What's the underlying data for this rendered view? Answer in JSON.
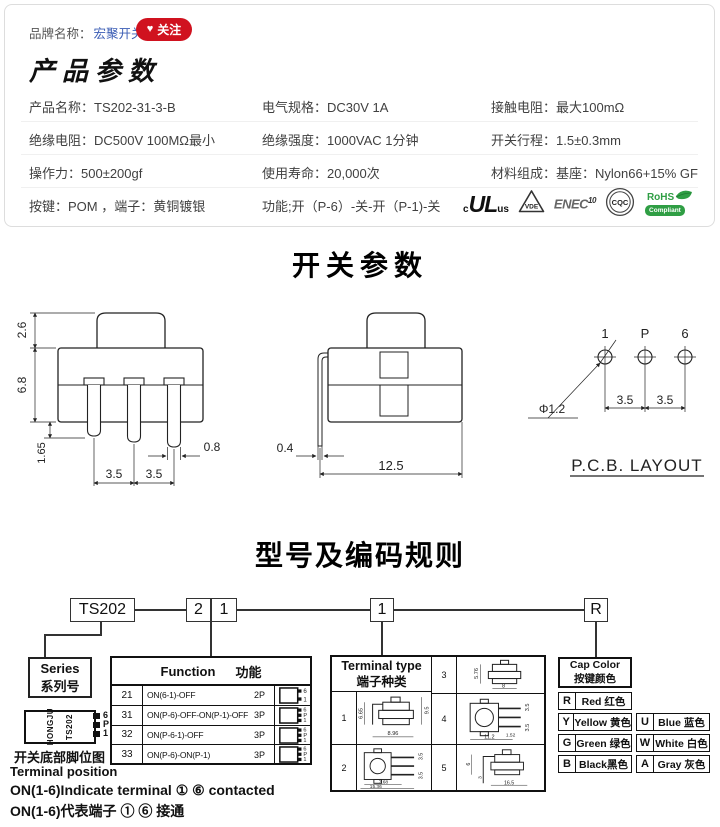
{
  "colors": {
    "brand_link": "#3b5db5",
    "follow_red": "#d0121f",
    "rohs_green": "#2f9e44"
  },
  "header": {
    "brand_label": "品牌名称：",
    "brand_name": "宏聚开关",
    "heart": "♥",
    "follow_label": "关注",
    "section_title": "产品参数"
  },
  "specs": {
    "rows": [
      {
        "c1": "产品名称：TS202-31-3-B",
        "c2": "电气规格：DC30V  1A",
        "c3": "接触电阻：最大100mΩ"
      },
      {
        "c1": "绝缘电阻：DC500V  100MΩ最小",
        "c2": "绝缘强度：1000VAC  1分钟",
        "c3": "开关行程：1.5±0.3mm"
      },
      {
        "c1": "操作力：500±200gf",
        "c2": "使用寿命：20,000次",
        "c3": "材料组成：基座：Nylon66+15% GF"
      },
      {
        "c1": "按键：POM ，端子：黄铜镀银",
        "c2": "功能;开（P-6）-关-开（P-1)-关"
      }
    ],
    "certs": {
      "ul_prefix": "c",
      "ul": "UL",
      "ul_suffix": "us",
      "vde": "VDE",
      "enec": "ENEC",
      "enec_num": "10",
      "cqc": "CQC",
      "rohs": "RoHS",
      "rohs_sub": "Compliant"
    }
  },
  "switch_section": {
    "title": "开关参数",
    "front": {
      "dim_26": "2.6",
      "dim_68": "6.8",
      "dim_165": "1.65",
      "dim_35a": "3.5",
      "dim_35b": "3.5",
      "dim_08": "0.8"
    },
    "side": {
      "dim_04": "0.4",
      "dim_125": "12.5"
    },
    "pcb": {
      "t1": "1",
      "tP": "P",
      "t6": "6",
      "hole": "Φ1.2",
      "p1": "3.5",
      "p2": "3.5",
      "caption": "P.C.B. LAYOUT"
    }
  },
  "coding": {
    "title": "型号及编码规则",
    "box_series": "TS202",
    "box_f1": "2",
    "box_f2": "1",
    "box_t": "1",
    "box_c": "R",
    "series_en": "Series",
    "series_cn": "系列号",
    "function": {
      "en": "Function",
      "cn": "功能",
      "rows": [
        {
          "code": "21",
          "desc": "ON(6-1)-OFF",
          "poles": "2P",
          "pins": [
            "6",
            "1"
          ]
        },
        {
          "code": "31",
          "desc": "ON(P-6)-OFF-ON(P-1)-OFF",
          "poles": "3P",
          "pins": [
            "6",
            "P",
            "1"
          ]
        },
        {
          "code": "32",
          "desc": "ON(P-6-1)-OFF",
          "poles": "3P",
          "pins": [
            "6",
            "P",
            "1"
          ]
        },
        {
          "code": "33",
          "desc": "ON(P-6)-ON(P-1)",
          "poles": "3P",
          "pins": [
            "6",
            "P",
            "1"
          ]
        }
      ]
    },
    "terminal": {
      "en": "Terminal type",
      "cn": "端子种类",
      "cells": [
        {
          "num": "1",
          "dims": [
            "6.65",
            "9.5",
            "8.96"
          ]
        },
        {
          "num": "2",
          "dims": [
            "3.5",
            "3.5",
            "7.68",
            "15.36"
          ]
        },
        {
          "num": "3",
          "dims": [
            "5.76",
            "8"
          ]
        },
        {
          "num": "4",
          "dims": [
            "3.5",
            "3.5",
            "1.52",
            "11.2"
          ]
        },
        {
          "num": "5",
          "dims": [
            "6",
            "3",
            "16.5"
          ]
        }
      ]
    },
    "cap": {
      "en": "Cap Color",
      "cn": "按键颜色",
      "left": [
        {
          "code": "R",
          "name": "Red 红色"
        },
        {
          "code": "Y",
          "name": "Yellow 黄色"
        },
        {
          "code": "G",
          "name": "Green 绿色"
        },
        {
          "code": "B",
          "name": "Black黑色"
        }
      ],
      "right": [
        {
          "code": "U",
          "name": "Blue 蓝色"
        },
        {
          "code": "W",
          "name": "White 白色"
        },
        {
          "code": "A",
          "name": "Gray 灰色"
        }
      ]
    },
    "chip": {
      "brand": "HONGJU",
      "model": "TS202",
      "pin6": "6",
      "pinP": "P",
      "pin1": "1"
    },
    "note_cn_label": "开关底部脚位图",
    "note_en_label": "Terminal position",
    "note_en": "ON(1-6)Indicate terminal ① ⑥ contacted",
    "note_cn": "ON(1-6)代表端子 ① ⑥ 接通"
  }
}
